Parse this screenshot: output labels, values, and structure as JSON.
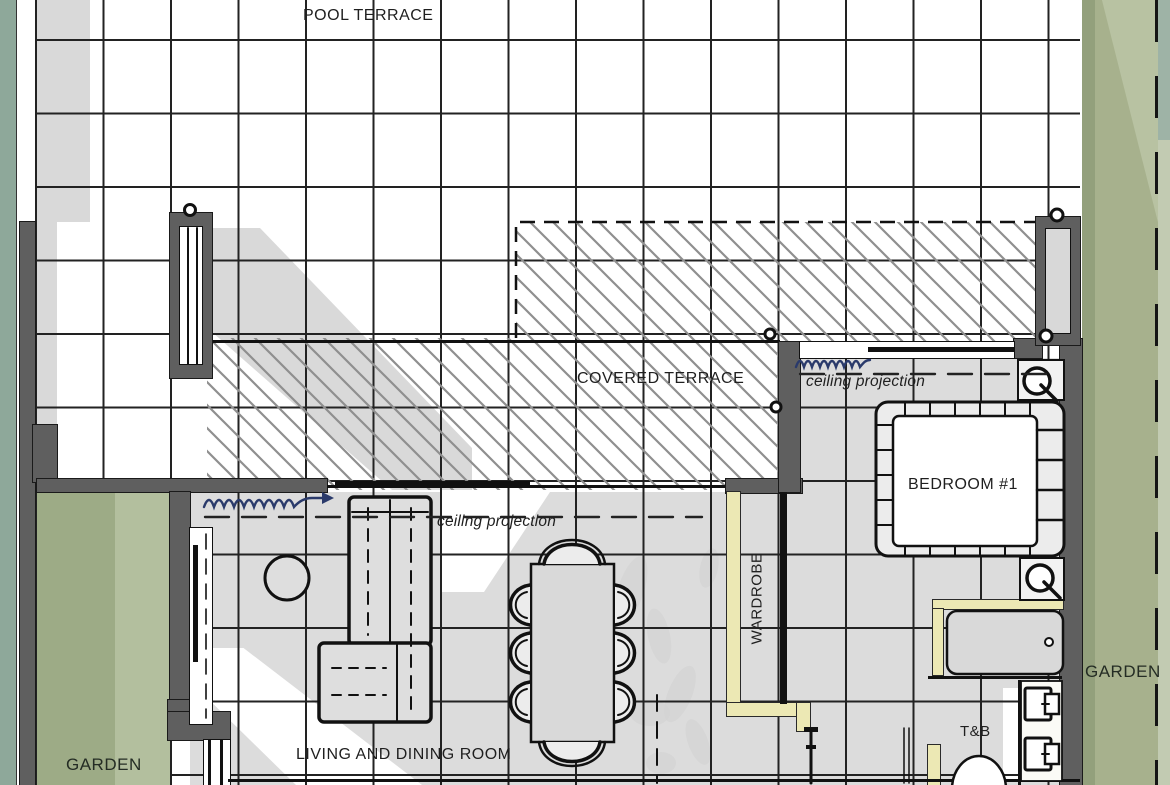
{
  "app": {
    "type": "architectural-floor-plan"
  },
  "labels": {
    "pool_terrace": "POOL TERRACE",
    "covered_terrace": "COVERED TERRACE",
    "ceiling_projection_living": "ceiling projection",
    "ceiling_projection_bedroom": "ceiling projection",
    "bedroom_1": "BEDROOM #1",
    "wardrobe": "WARDROBE",
    "living_dining": "LIVING AND DINING ROOM",
    "toilet_bath": "T&B",
    "garden_left": "GARDEN",
    "garden_right": "GARDEN"
  },
  "colors": {
    "teal_edge_strip": "#8ea89a",
    "garden_green": "#a7b18d",
    "garden_green_light": "#b8c2a2",
    "garden_green_dark": "#93a07c",
    "wall_gray": "#5f5f5f",
    "floor_shadow_gray": "#dcdcdc",
    "yellow_wall": "#ece8b4",
    "hatch_line_gray": "#8f8f8f",
    "insulation_blue": "#2a3a6b",
    "grid_line": "#222222"
  },
  "icons": [
    "sofa",
    "side-table",
    "dining-table",
    "dining-chair",
    "bed",
    "nightstand",
    "wall-lamp",
    "bathtub",
    "sink",
    "toilet",
    "window",
    "door",
    "insulation-squiggle",
    "roof-hatch",
    "ceiling-projection-dashes",
    "door-knob"
  ]
}
